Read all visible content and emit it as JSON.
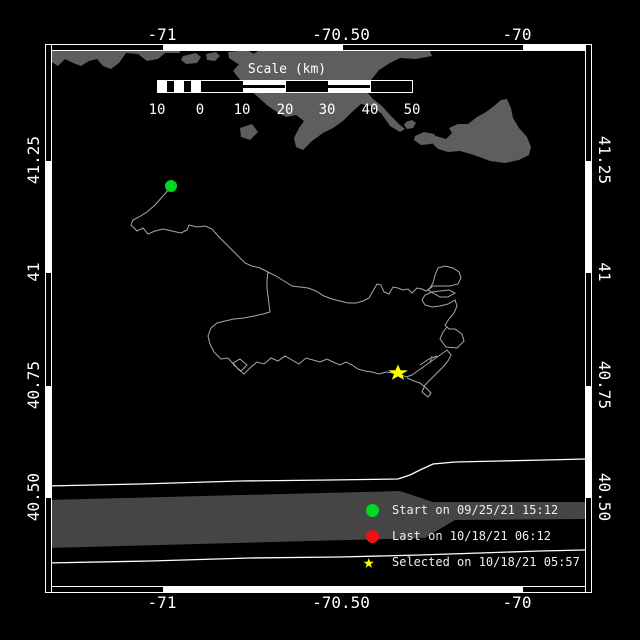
{
  "colors": {
    "background": "#000000",
    "land": "#5e5e5e",
    "band": "#454545",
    "track": "#a8a8a8",
    "coast_line": "#ffffff",
    "start_green": "#00d822",
    "last_red": "#ee1111",
    "selected_yellow": "#ffff00",
    "frame": "#ffffff"
  },
  "axes": {
    "top": [
      {
        "label": "-71"
      },
      {
        "label": "-70.50"
      },
      {
        "label": "-70"
      }
    ],
    "bottom": [
      {
        "label": "-71"
      },
      {
        "label": "-70.50"
      },
      {
        "label": "-70"
      }
    ],
    "left": [
      {
        "label": "41.25"
      },
      {
        "label": "41"
      },
      {
        "label": "40.75"
      },
      {
        "label": "40.50"
      }
    ],
    "right": [
      {
        "label": "41.25"
      },
      {
        "label": "41"
      },
      {
        "label": "40.75"
      },
      {
        "label": "40.50"
      }
    ]
  },
  "scalebar": {
    "title": "Scale (km)",
    "tick_labels": [
      "10",
      "0",
      "10",
      "20",
      "30",
      "40",
      "50"
    ]
  },
  "legend": {
    "items": [
      {
        "marker": "circle",
        "color": "#00d822",
        "label": "Start on 09/25/21 15:12"
      },
      {
        "marker": "circle",
        "color": "#ee1111",
        "label": "Last on 10/18/21 06:12"
      },
      {
        "marker": "star",
        "color": "#ffff00",
        "label": "Selected on 10/18/21 05:57"
      }
    ]
  },
  "markers": {
    "start": {
      "x": 171,
      "y": 186
    },
    "selected": {
      "x": 398,
      "y": 373,
      "transform": "translate(398,373) scale(1.05,0.85)"
    }
  },
  "map_geometry": {
    "land_strip_west": "46,51 180,51 180,53 165,53 158,59 147,61 138,54 126,53 119,63 111,69 103,66 97,59 89,61 81,66 73,63 65,59 58,66 50,61 46,59",
    "land_islet_a": "183,56 196,53 201,57 197,63 186,64 181,60",
    "land_islet_b": "206,54 216,52 220,56 215,61 207,60",
    "land_islet_c": "228,52 247,50 256,55 252,62 238,64 229,58",
    "land_cape_mass": "258,51 430,51 432,56 416,59 400,58 390,63 379,70 371,80 366,91 373,99 382,106 391,116 400,125 405,129 400,132 390,126 381,113 371,106 361,104 352,112 343,121 333,128 323,133 312,141 303,150 296,147 294,138 299,128 304,121 296,115 286,117 277,112 268,106 258,97 249,89 241,81 233,71 240,63 250,56",
    "land_shoal": "240,128 252,124 258,132 250,140 241,137",
    "land_nantucket": "507,99 511,108 513,118 519,128 527,137 531,147 529,155 519,160 505,163 490,161 474,155 460,151 448,152 438,149 431,142 436,136 446,139 452,133 449,128 458,124 468,124 477,117 486,112 494,106 501,100",
    "land_islets_small": "M406,122 l6,-2 4,3 -3,5 -6,1 -3,-4 z M415,136 l9,-4 10,2 4,5 -7,5 -10,1 -7,-5 z",
    "band": "46,500 400,491 433,502 585,502 585,519 455,520 425,538 46,548",
    "lane_upper": "M46,486 L140,484 L240,481 L330,480 L398,479 L410,475 L420,470 L433,464 L455,462 L500,461 L545,460 L585,459",
    "lane_lower": "M46,563 L150,561 L250,558 L340,557 L420,555 L480,553 L540,551 L585,550",
    "track": "M171,187 L163,196 L155,205 L147,212 L139,217 L133,220 L131,225 L137,231 L143,228 L148,234 L155,231 L163,229 L172,231 L181,233 L187,230 L189,225 L197,227 L205,226 L212,229 L218,236 L225,243 L232,250 L239,257 L245,263 L252,266 L260,268 L268,272 L276,276 L284,281 L292,286 L300,287 L308,288 L316,291 L324,296 L332,299 L340,301 L348,303 L356,303 L363,301 L369,298 L373,291 L377,284 L381,285 L384,292 L389,294 L393,287 L398,288 L403,290 L408,289 L412,293 L417,288 L422,289 L426,291 L430,288 L433,283 L435,275 L438,268 L445,266 L453,268 L459,272 L461,278 L458,284 L450,286 L441,286 L433,286 L428,290 L433,293 L440,297 L448,297 L455,293 L449,290 L440,291 L432,292 L425,295 L422,300 L425,305 L432,307 L440,306 L448,304 L455,300 L457,306 L454,313 L449,319 L445,325 L449,329 L455,329 L462,334 L464,341 L457,348 L446,347 L440,339 L443,332 L447,327 M268,272 L267,280 L267,288 L268,296 L269,304 L270,312 L263,314 L254,316 L244,318 L234,319 L225,321 L217,323 L211,328 L208,336 L210,344 L214,352 L221,359 L228,358 L235,366 L241,371 L247,365 L240,359 L233,363 L238,369 L244,374 L250,368 L257,362 L264,364 L271,358 L278,361 L285,356 L292,360 L299,364 L306,358 L313,360 L320,362 L327,359 L333,362 L340,365 L346,362 L352,365 L358,369 L365,371 L372,372 L379,374 L386,372 L393,373 L400,374 L406,377 L412,375 L419,370 L426,365 L433,360 L440,355 L447,350 L451,355 L448,361 L443,367 L437,373 L431,379 L425,385 L422,392 L428,397 L431,393 L426,388 L420,383 L414,381 L407,378 M420,365 L429,359 L437,356 M432,356 L430,363",
    "star_path": "M0,-10 L2.4,-3.2 L9.5,-3.1 L3.8,1.2 L5.9,8.1 L0,4 L-5.9,8.1 L-3.8,1.2 L-9.5,-3.1 L-2.4,-3.2 Z"
  }
}
